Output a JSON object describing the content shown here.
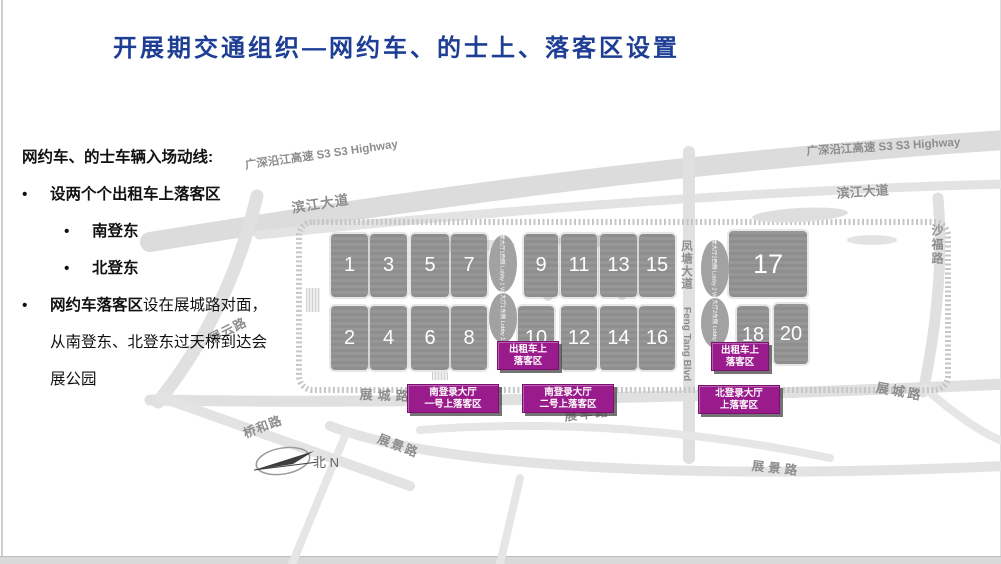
{
  "title": "开展期交通组织—网约车、的士上、落客区设置",
  "colors": {
    "title_blue": "#1d3e94",
    "marker_purple": "#9a1b8c"
  },
  "notes": {
    "bullet": "•",
    "heading": "网约车、的士车辆入场动线:",
    "item1": "设两个个出租车上落客区",
    "item1_sub1": "南登东",
    "item1_sub2": "北登东",
    "item2_bold": "网约车落客区",
    "item2_rest1": "设在展城路对面，",
    "item2_rest2": "从南登东、北登东过天桥到达会展公园"
  },
  "map": {
    "halls": [
      "1",
      "3",
      "5",
      "7",
      "9",
      "11",
      "13",
      "15",
      "17",
      "2",
      "4",
      "6",
      "8",
      "10",
      "12",
      "14",
      "16",
      "18",
      "20"
    ],
    "lobbies": {
      "l1w": "登录大厅1西侧 Lobby 1 West",
      "l1e": "登录大厅1东侧 Lobby 1 East",
      "l2w": "登录大厅2西侧 Lobby 2 West",
      "l2e": "登录大厅2东侧 Lobby 2 East"
    },
    "roads": {
      "highway": "广深沿江高速 S3  S3 Highway",
      "binjiang": "滨江大道",
      "shafu": "沙福路",
      "fengtang": "凤塘大道",
      "fengtang_en": "Feng Tang Blvd",
      "zhancheng": "展城路",
      "zhanyun": "展云路",
      "qiaohe": "桥和路",
      "zhanjing": "展景路",
      "zhanfeng": "展丰路",
      "north": "北 N"
    },
    "markers": {
      "taxi_line1": "出租车上",
      "taxi_line2": "落客区",
      "south1_line1": "南登录大厅",
      "south1_line2": "一号上落客区",
      "south2_line1": "南登录大厅",
      "south2_line2": "二号上落客区",
      "north_line1": "北登录大厅",
      "north_line2": "上落客区"
    }
  }
}
